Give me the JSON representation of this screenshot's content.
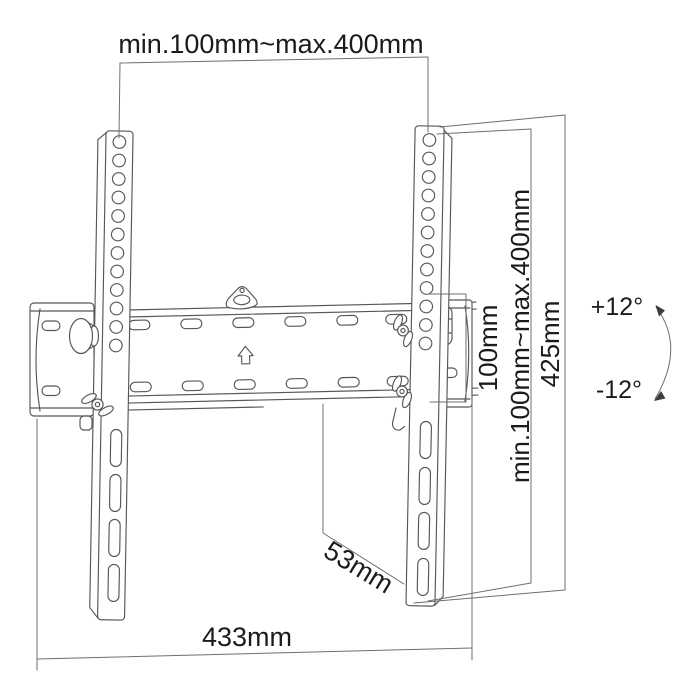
{
  "diagram": {
    "subject": "tilting TV wall mount technical drawing",
    "background": "#ffffff",
    "line_color": "#575757",
    "text_color": "#1b1b1b",
    "labels": {
      "top_width": "min.100mm~max.400mm",
      "vesa_height": "100mm",
      "vesa_width_range": "min.100mm~max.400mm",
      "column_height": "425mm",
      "tilt_up": "+12°",
      "tilt_down": "-12°",
      "depth": "53mm",
      "total_width": "433mm"
    },
    "icons": {
      "up_arrow": "up-arrow-icon",
      "hook": "hook-icon",
      "tilt_arc": "tilt-arc-arrow-icon"
    }
  }
}
